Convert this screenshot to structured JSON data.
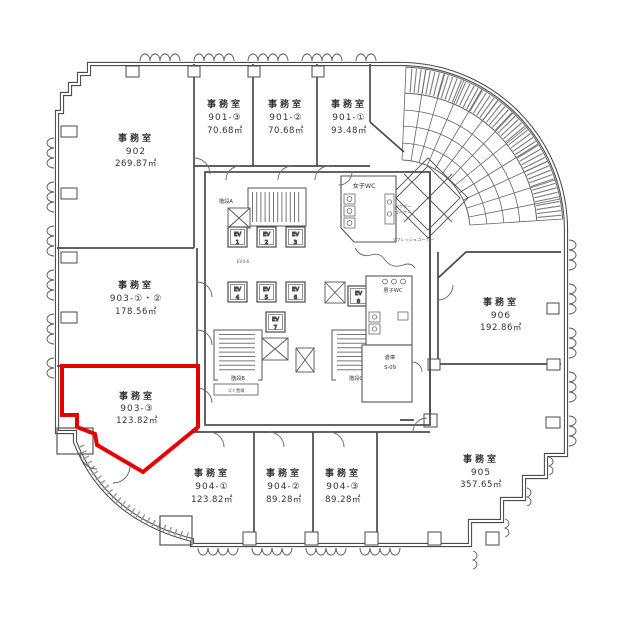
{
  "plan": {
    "highlight_color": "#e60000",
    "wall_color": "#4a4a4a"
  },
  "rooms": [
    {
      "type": "事務室",
      "number": "902",
      "area": "269.87㎡"
    },
    {
      "type": "事務室",
      "number": "901-③",
      "area": "70.68㎡"
    },
    {
      "type": "事務室",
      "number": "901-②",
      "area": "70.68㎡"
    },
    {
      "type": "事務室",
      "number": "901-①",
      "area": "93.48㎡"
    },
    {
      "type": "事務室",
      "number": "903-①・②",
      "area": "178.56㎡"
    },
    {
      "type": "事務室",
      "number": "903-③",
      "area": "123.82㎡",
      "highlighted": true
    },
    {
      "type": "事務室",
      "number": "904-①",
      "area": "123.82㎡"
    },
    {
      "type": "事務室",
      "number": "904-②",
      "area": "89.28㎡"
    },
    {
      "type": "事務室",
      "number": "904-③",
      "area": "89.28㎡"
    },
    {
      "type": "事務室",
      "number": "905",
      "area": "357.65㎡"
    },
    {
      "type": "事務室",
      "number": "906",
      "area": "192.86㎡"
    }
  ],
  "core": {
    "ev_label": "EV",
    "ev_numbers": [
      "1",
      "2",
      "3",
      "4",
      "5",
      "6",
      "7",
      "8"
    ],
    "ev_hall": "EV4-6",
    "stair_a": "階段A",
    "stair_b": "階段B",
    "stair_c": "階段C",
    "garbage": "ゴミ置場",
    "womens_wc": "女子WC",
    "mens_wc": "男子WC",
    "storage": "倉庫",
    "storage_no": "S-09",
    "powder1": "パウダー",
    "powder2": "コーナー",
    "refresh": "リフレッシュコーナー"
  }
}
